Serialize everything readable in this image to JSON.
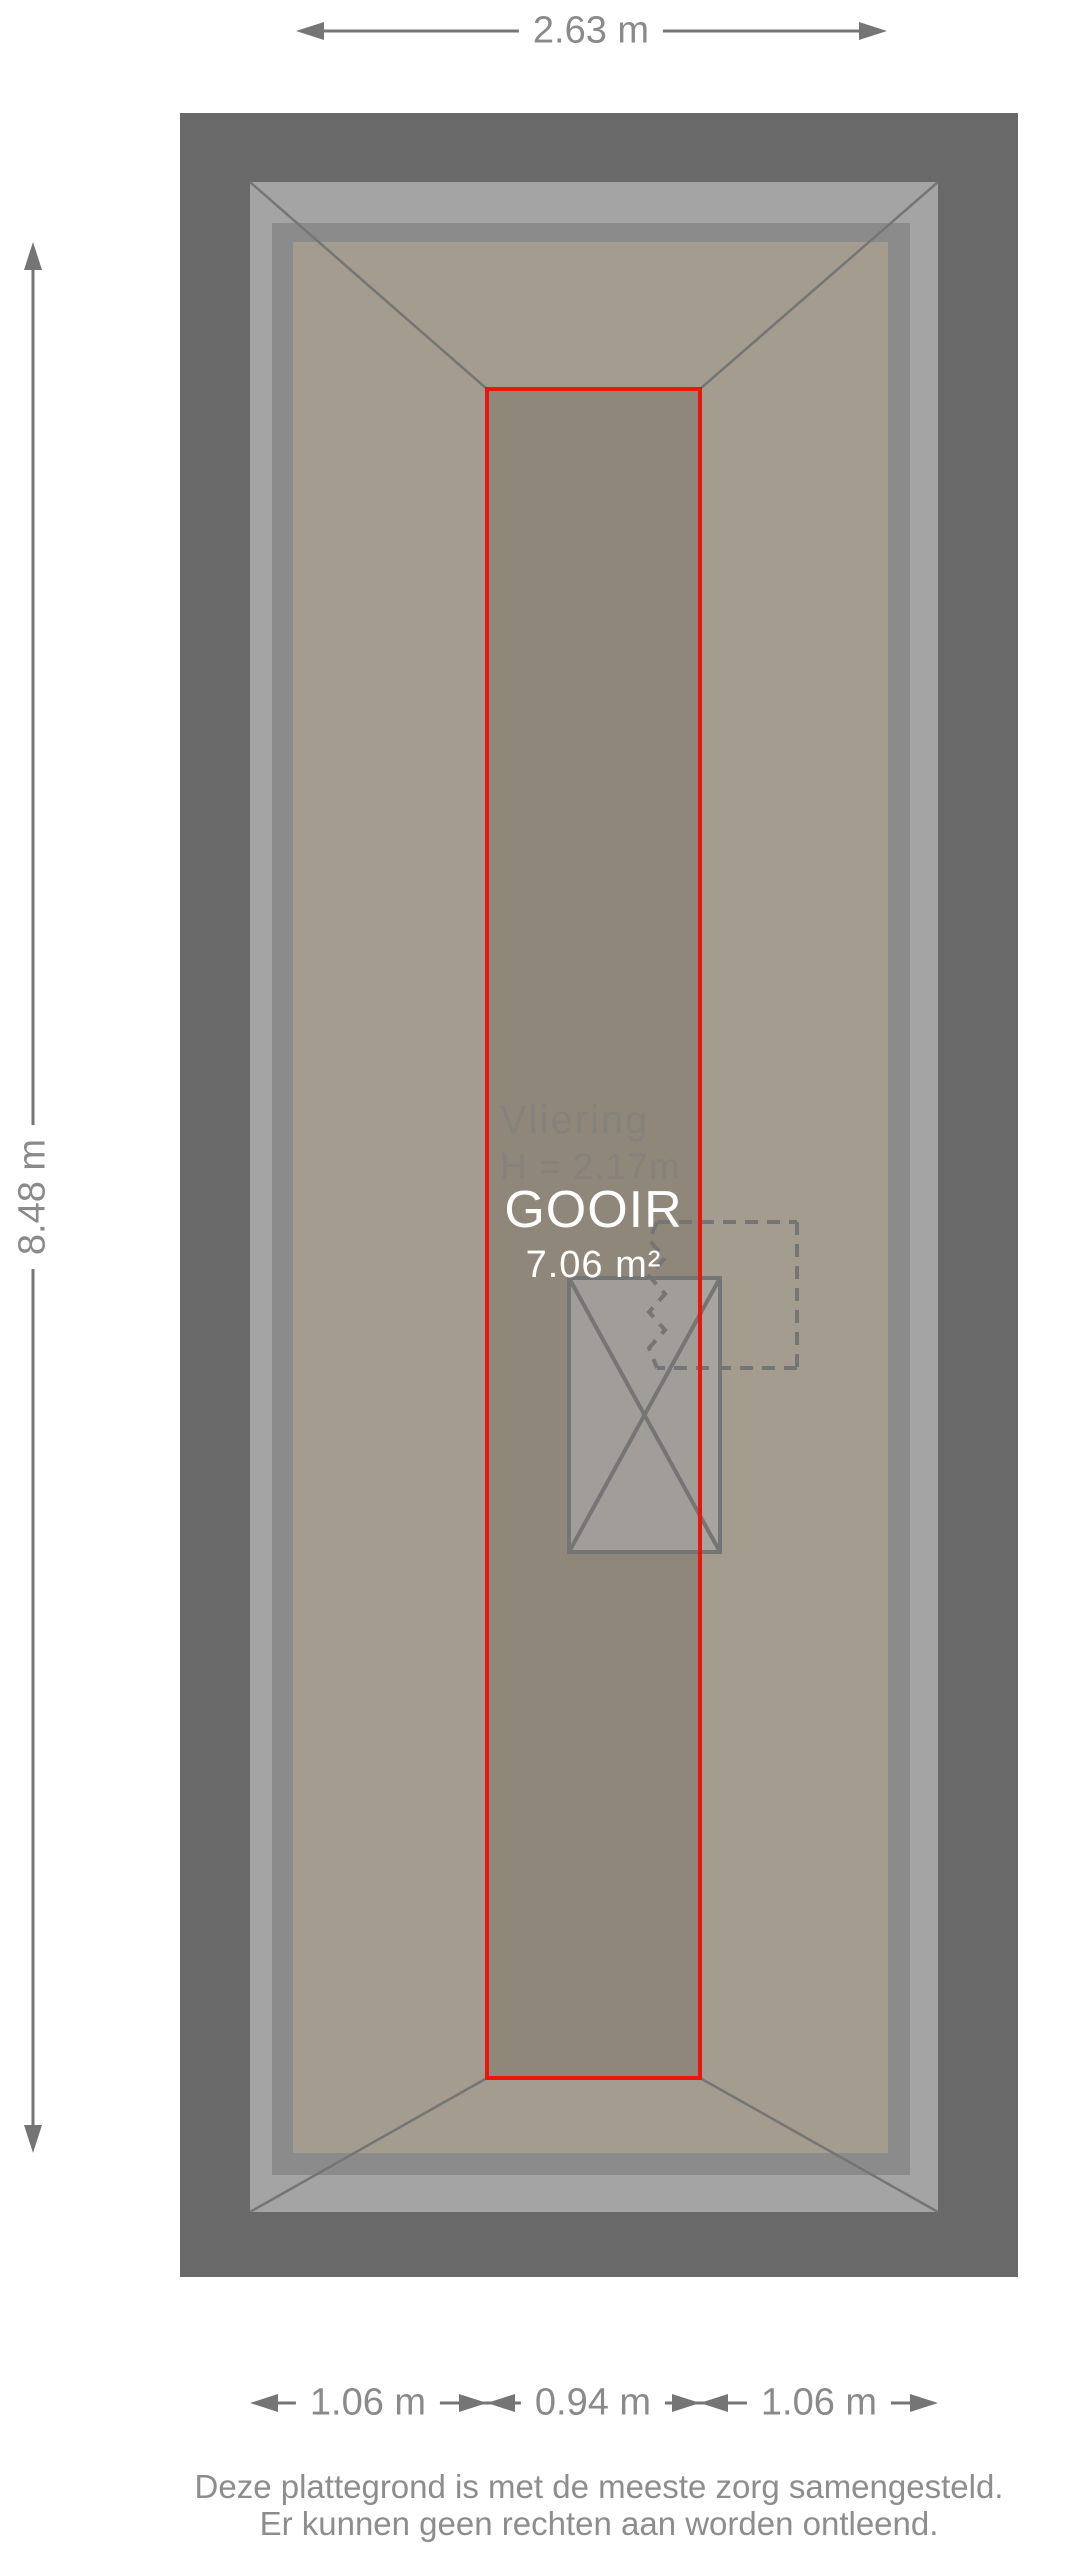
{
  "document": {
    "type": "floorplan",
    "floor_name": "Vliering"
  },
  "dimensions": {
    "top": "2.63 m",
    "left": "8.48 m",
    "bottom": [
      "1.06 m",
      "0.94 m",
      "1.06 m"
    ]
  },
  "room": {
    "name": "Vliering",
    "height_label": "H = 2.17m",
    "watermark": "GOOIR",
    "area": "7.06 m²"
  },
  "footer": {
    "line1": "Deze plattegrond is met de meeste zorg samengesteld.",
    "line2": "Er kunnen geen rechten aan worden ontleend."
  },
  "colors": {
    "frame_dark": "#696969",
    "frame_light": "#a4a4a4",
    "frame_mid": "#8b8b8b",
    "floor": "#a49c8e",
    "loft_floor": "#8f877a",
    "stair_fill": "rgba(170,170,170,0.65)",
    "outline": "#757575",
    "accent_red": "#e8160c",
    "dim_line": "#757575",
    "dim_text": "#8a8a8a",
    "plan_text": "#85817b",
    "white_text": "#ffffff",
    "footer_text": "#8d8d8d"
  }
}
